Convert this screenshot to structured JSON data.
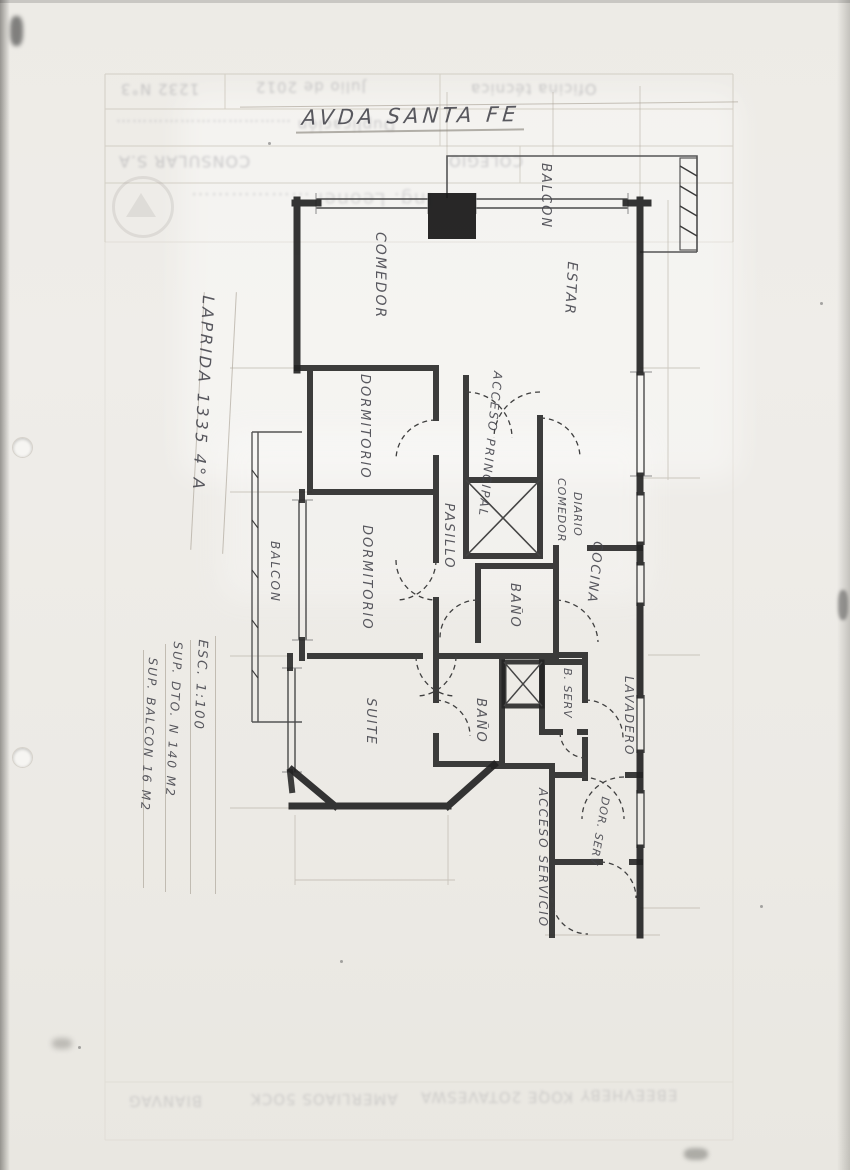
{
  "title": {
    "street": "AVDA SANTA FE"
  },
  "plan": {
    "labels": {
      "comedor": "COMEDOR",
      "balcon_top": "BALCON",
      "estar": "ESTAR",
      "dormitorio_1": "DORMITORIO",
      "acceso_principal": "ACCESO PRINCIPAL",
      "comedor_diario_line1": "COMEDOR",
      "comedor_diario_line2": "DIARIO",
      "pasillo": "PASILLO",
      "cocina": "COCINA",
      "balcon_left": "BALCON",
      "dormitorio_2": "DORMITORIO",
      "bano_1": "BAÑO",
      "suite": "SUITE",
      "bano_2": "BAÑO",
      "bano_servicio": "B. SERV",
      "lavadero": "LAVADERO",
      "dormitorio_servicio": "DOR. SERV",
      "acceso_servicio": "ACCESO SERVICIO"
    },
    "annotations": {
      "address": "LAPRIDA 1335 4°A",
      "scale": "ESC. 1:100",
      "surface_depto": "SUP. DTO. N 140 M2",
      "surface_balcon": "SUP. BALCON 16 M2"
    }
  },
  "form_ghost": {
    "row1_left": "1232 N°3",
    "row1_mid": "Julio de 2012",
    "row1_right": "Oficina técnica",
    "row2": "Duplicación ……………………………",
    "row3_left": "CONSULAR S.A",
    "row3_right": "COLEGIO",
    "logo_text": "Ing. Leonel ………………",
    "bottom_illegible_1": "BIANVAG",
    "bottom_illegible_2": "AMERLIAOS 5OCK",
    "bottom_illegible_3": "KOQE 2OTAVESWA",
    "bottom_illegible_4": "EBEEVHEBY"
  },
  "colors": {
    "paper": "#edebe6",
    "ink_wall": "#202020",
    "pencil_text": "#43434b",
    "guide_line": "#b2ab9f"
  }
}
